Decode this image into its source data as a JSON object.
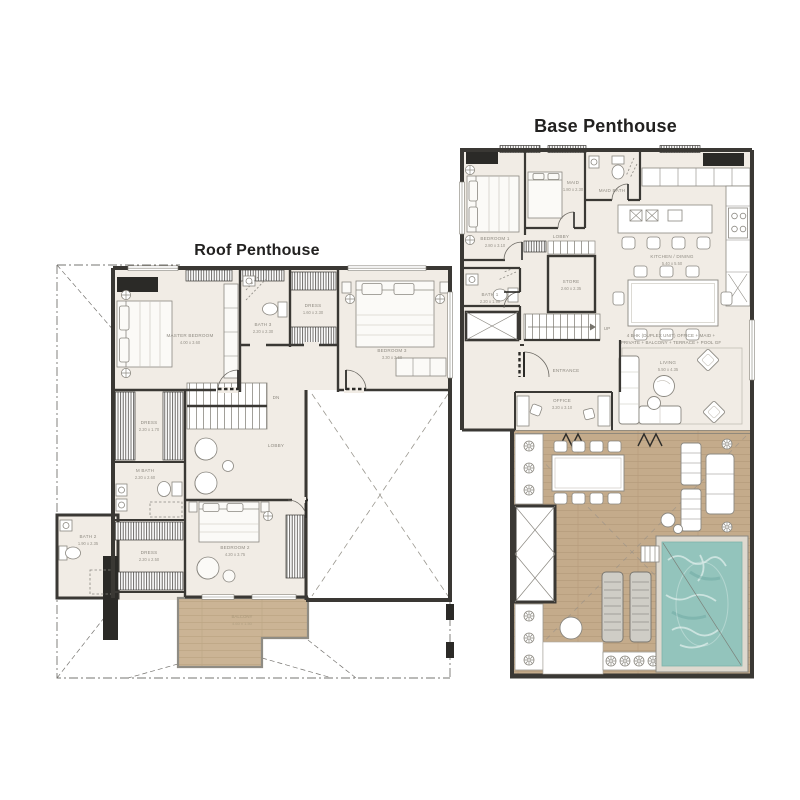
{
  "sheet": {
    "background": "#ffffff"
  },
  "colors": {
    "wall": "#3a3834",
    "floor": "#f1ece5",
    "wood_roof": "#cbb495",
    "wood_terrace": "#c4ab8b",
    "pool_water": "#93c4bc",
    "furniture_line": "#8b8881",
    "label_text": "#8f8b82",
    "title_text": "#222120"
  },
  "roof_plan": {
    "title": "Roof Penthouse",
    "stairs_label": "DN",
    "rooms": {
      "master_bedroom": {
        "name": "MASTER BEDROOM",
        "dims": "4.00 x 3.60"
      },
      "bedroom2": {
        "name": "BEDROOM 2",
        "dims": "4.20 x 3.75"
      },
      "bedroom3": {
        "name": "BEDROOM 3",
        "dims": "3.30 x 3.60"
      },
      "dress_master": {
        "name": "DRESS",
        "dims": "2.20 x 1.70"
      },
      "dress2": {
        "name": "DRESS",
        "dims": "2.20 x 2.50"
      },
      "dress3": {
        "name": "DRESS",
        "dims": "1.60 x 2.30"
      },
      "m_bath": {
        "name": "M BATH",
        "dims": "2.20 x 2.60"
      },
      "bath2": {
        "name": "BATH 2",
        "dims": "1.90 x 2.35"
      },
      "bath3": {
        "name": "BATH 3",
        "dims": "2.20 x 2.30"
      },
      "lobby": {
        "name": "LOBBY"
      },
      "balcony": {
        "name": "BALCONY",
        "dims": "4.60 x 1.50"
      }
    }
  },
  "base_plan": {
    "title": "Base Penthouse",
    "stairs_label": "UP",
    "annotation": {
      "line1": "4 BHK (DUPLEX UNIT) OFFICE + MAID +",
      "line2": "PRIVATE + BALCONY + TERRACE + POOL GF"
    },
    "rooms": {
      "bedroom1": {
        "name": "BEDROOM 1",
        "dims": "2.80 x 3.10"
      },
      "maid": {
        "name": "MAID",
        "dims": "1.80 x 2.30"
      },
      "maid_bath": {
        "name": "MAID BATH",
        "dims": "2.20 x 1.20"
      },
      "bath1": {
        "name": "BATH 1",
        "dims": "2.20 x 1.90"
      },
      "store": {
        "name": "STORE",
        "dims": "2.60 x 2.35"
      },
      "kitchen_dining": {
        "name": "KITCHEN / DINING",
        "dims": "5.40 x 5.50"
      },
      "living": {
        "name": "LIVING",
        "dims": "5.50 x 4.35"
      },
      "office": {
        "name": "OFFICE",
        "dims": "3.20 x 3.10"
      },
      "lobby": {
        "name": "LOBBY"
      },
      "entrance": {
        "name": "ENTRANCE"
      }
    }
  }
}
